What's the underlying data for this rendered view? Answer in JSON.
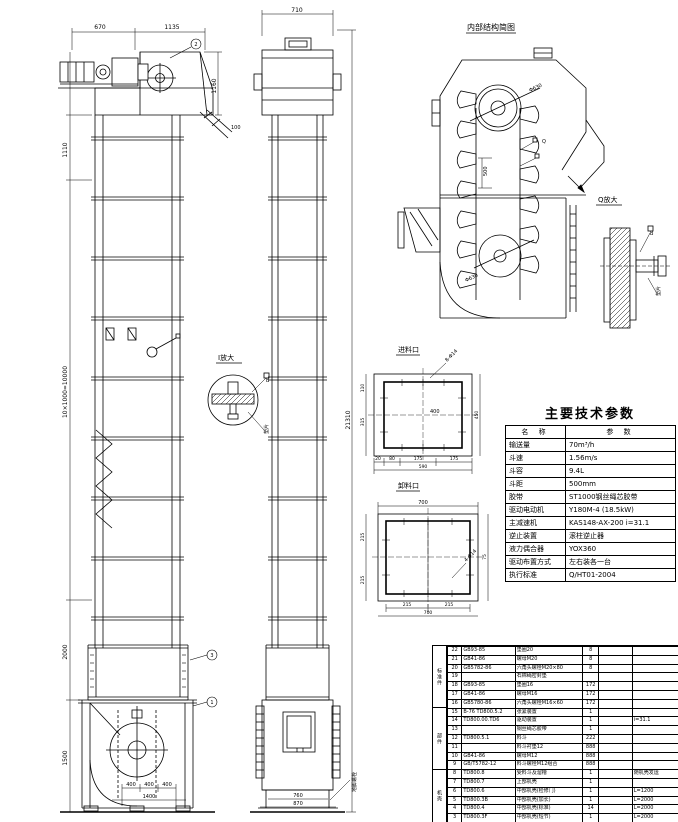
{
  "doc": {
    "type": "bucket-elevator engineering drawing",
    "bg": "#ffffff",
    "line_color": "#000000"
  },
  "labels": {
    "schematic_title": "内部结构简图",
    "detail_q": "Q放大",
    "detail_i": "I放大",
    "inlet_view": "进料口",
    "outlet_view": "卸料口",
    "anchor_note": "地脚螺栓",
    "q_note": "垫片",
    "i_note": "垫片",
    "q_callout": "B",
    "i_callout": "B",
    "schematic_callout": "Q"
  },
  "callouts": {
    "c1": "1",
    "c2": "2",
    "c3": "3"
  },
  "dims": {
    "front_top": [
      "670",
      "1135"
    ],
    "front_head_right": "1160",
    "front_head_small": "100",
    "front_left": [
      "1110",
      "10×1000=10000",
      "2000",
      "1500"
    ],
    "front_bottom": [
      "400",
      "400",
      "400"
    ],
    "front_bottom_total": "1400",
    "side_top": "710",
    "side_total": "21310",
    "side_bottom": [
      "760",
      "870"
    ],
    "head_dia": "Φ630",
    "boot_dia": "Φ630",
    "bucket_pitch": "500",
    "inlet": {
      "leader": "8-Φ14",
      "bottom": [
        "20",
        "80",
        "175",
        "175"
      ],
      "bottom_total": "590",
      "left_a": "110",
      "left_b": "315",
      "right": "450",
      "center": "400"
    },
    "outlet": {
      "leader": "4-Φ14",
      "top": "700",
      "left_a": "215",
      "left_b": "215",
      "right": "75",
      "bottom_a": "215",
      "bottom_b": "215",
      "bottom_total": "700"
    }
  },
  "params": {
    "title": "主要技术参数",
    "header": {
      "name": "名  称",
      "value": "参  数"
    },
    "rows": [
      {
        "name": "输送量",
        "value": "70m³/h"
      },
      {
        "name": "斗速",
        "value": "1.56m/s"
      },
      {
        "name": "斗容",
        "value": "9.4L"
      },
      {
        "name": "斗距",
        "value": "500mm"
      },
      {
        "name": "胶带",
        "value": "ST1000钢丝绳芯胶带"
      },
      {
        "name": "驱动电动机",
        "value": "Y180M-4 (18.5kW)"
      },
      {
        "name": "主减速机",
        "value": "KAS148-AX-200  i=31.1"
      },
      {
        "name": "逆止装置",
        "value": "滚柱逆止器"
      },
      {
        "name": "液力偶合器",
        "value": "YOX360"
      },
      {
        "name": "驱动布置方式",
        "value": "左右装各一台"
      },
      {
        "name": "执行标准",
        "value": "Q/HT01-2004"
      }
    ]
  },
  "bom": {
    "groups": [
      {
        "label": "标准件"
      },
      {
        "label": "部件"
      },
      {
        "label": "机壳"
      }
    ],
    "rows": [
      {
        "no": "22",
        "code": "GB93-85",
        "name": "垫圈20",
        "qty": "8",
        "mat": "",
        "rk": ""
      },
      {
        "no": "21",
        "code": "GB41-86",
        "name": "螺母M20",
        "qty": "8",
        "mat": "",
        "rk": ""
      },
      {
        "no": "20",
        "code": "GB5782-86",
        "name": "六角头螺栓M20×80",
        "qty": "8",
        "mat": "",
        "rk": ""
      },
      {
        "no": "19",
        "code": "",
        "name": "石棉绳密封垫",
        "qty": "",
        "mat": "",
        "rk": ""
      },
      {
        "no": "18",
        "code": "GB93-85",
        "name": "垫圈16",
        "qty": "172",
        "mat": "",
        "rk": ""
      },
      {
        "no": "17",
        "code": "GB41-86",
        "name": "螺母M16",
        "qty": "172",
        "mat": "",
        "rk": ""
      },
      {
        "no": "16",
        "code": "GB5780-86",
        "name": "六角头螺栓M16×60",
        "qty": "172",
        "mat": "",
        "rk": ""
      },
      {
        "no": "15",
        "code": "B-76 TD800.5.2",
        "name": "张紧装置",
        "qty": "1",
        "mat": "",
        "rk": ""
      },
      {
        "no": "14",
        "code": "TD800.00.TD6",
        "name": "驱动装置",
        "qty": "1",
        "mat": "",
        "rk": "i=31.1"
      },
      {
        "no": "13",
        "code": "",
        "name": "钢丝绳芯胶带",
        "qty": "1",
        "mat": "",
        "rk": ""
      },
      {
        "no": "12",
        "code": "TD800.5.1",
        "name": "料斗",
        "qty": "222",
        "mat": "",
        "rk": ""
      },
      {
        "no": "11",
        "code": "",
        "name": "料斗衬垫12",
        "qty": "888",
        "mat": "",
        "rk": ""
      },
      {
        "no": "10",
        "code": "GB41-86",
        "name": "螺母M12",
        "qty": "888",
        "mat": "",
        "rk": ""
      },
      {
        "no": "9",
        "code": "GB/T5782-12",
        "name": "料斗螺栓M12组合",
        "qty": "888",
        "mat": "",
        "rk": ""
      },
      {
        "no": "8",
        "code": "TD800.8",
        "name": "受料斗及溜槽",
        "qty": "1",
        "mat": "",
        "rk": "随机壳发运"
      },
      {
        "no": "7",
        "code": "TD800.7",
        "name": "上部机壳",
        "qty": "1",
        "mat": "",
        "rk": ""
      },
      {
        "no": "6",
        "code": "TD800.6",
        "name": "中部机壳(检修门)",
        "qty": "1",
        "mat": "",
        "rk": "L=1200"
      },
      {
        "no": "5",
        "code": "TD800.3B",
        "name": "中部机壳(加长)",
        "qty": "1",
        "mat": "",
        "rk": "L=2000"
      },
      {
        "no": "4",
        "code": "TD800.4",
        "name": "中部机壳(标准)",
        "qty": "14",
        "mat": "",
        "rk": "L=2000"
      },
      {
        "no": "3",
        "code": "TD800.3F",
        "name": "中部机壳(短节)",
        "qty": "1",
        "mat": "",
        "rk": "L=2000"
      }
    ]
  }
}
